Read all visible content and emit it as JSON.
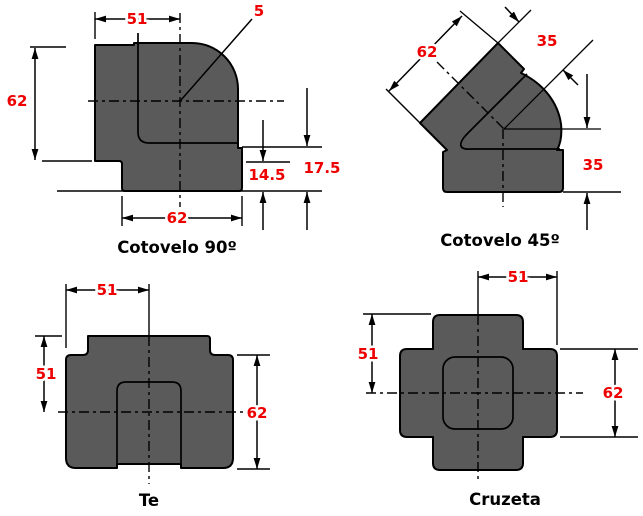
{
  "colors": {
    "background": "#ffffff",
    "fill": "#5a5a5a",
    "line": "#000000",
    "dimension": "#ee0000",
    "title": "#000000"
  },
  "figures": [
    {
      "id": "cotovelo-90",
      "title": "Cotovelo 90º",
      "dimensions": {
        "top_width": "51",
        "corner_radius": "5",
        "left_height": "62",
        "bottom_width": "62",
        "socket_offset": "14.5",
        "end_offset": "17.5"
      }
    },
    {
      "id": "cotovelo-45",
      "title": "Cotovelo 45º",
      "dimensions": {
        "mouth_width": "62",
        "center_to_face_upper": "35",
        "center_to_face_lower": "35"
      }
    },
    {
      "id": "te",
      "title": "Te",
      "dimensions": {
        "center_to_left_face": "51",
        "top_to_center": "51",
        "side_height": "62"
      }
    },
    {
      "id": "cruzeta",
      "title": "Cruzeta",
      "dimensions": {
        "center_to_right_face": "51",
        "top_to_center": "51",
        "arm_diameter": "62"
      }
    }
  ]
}
